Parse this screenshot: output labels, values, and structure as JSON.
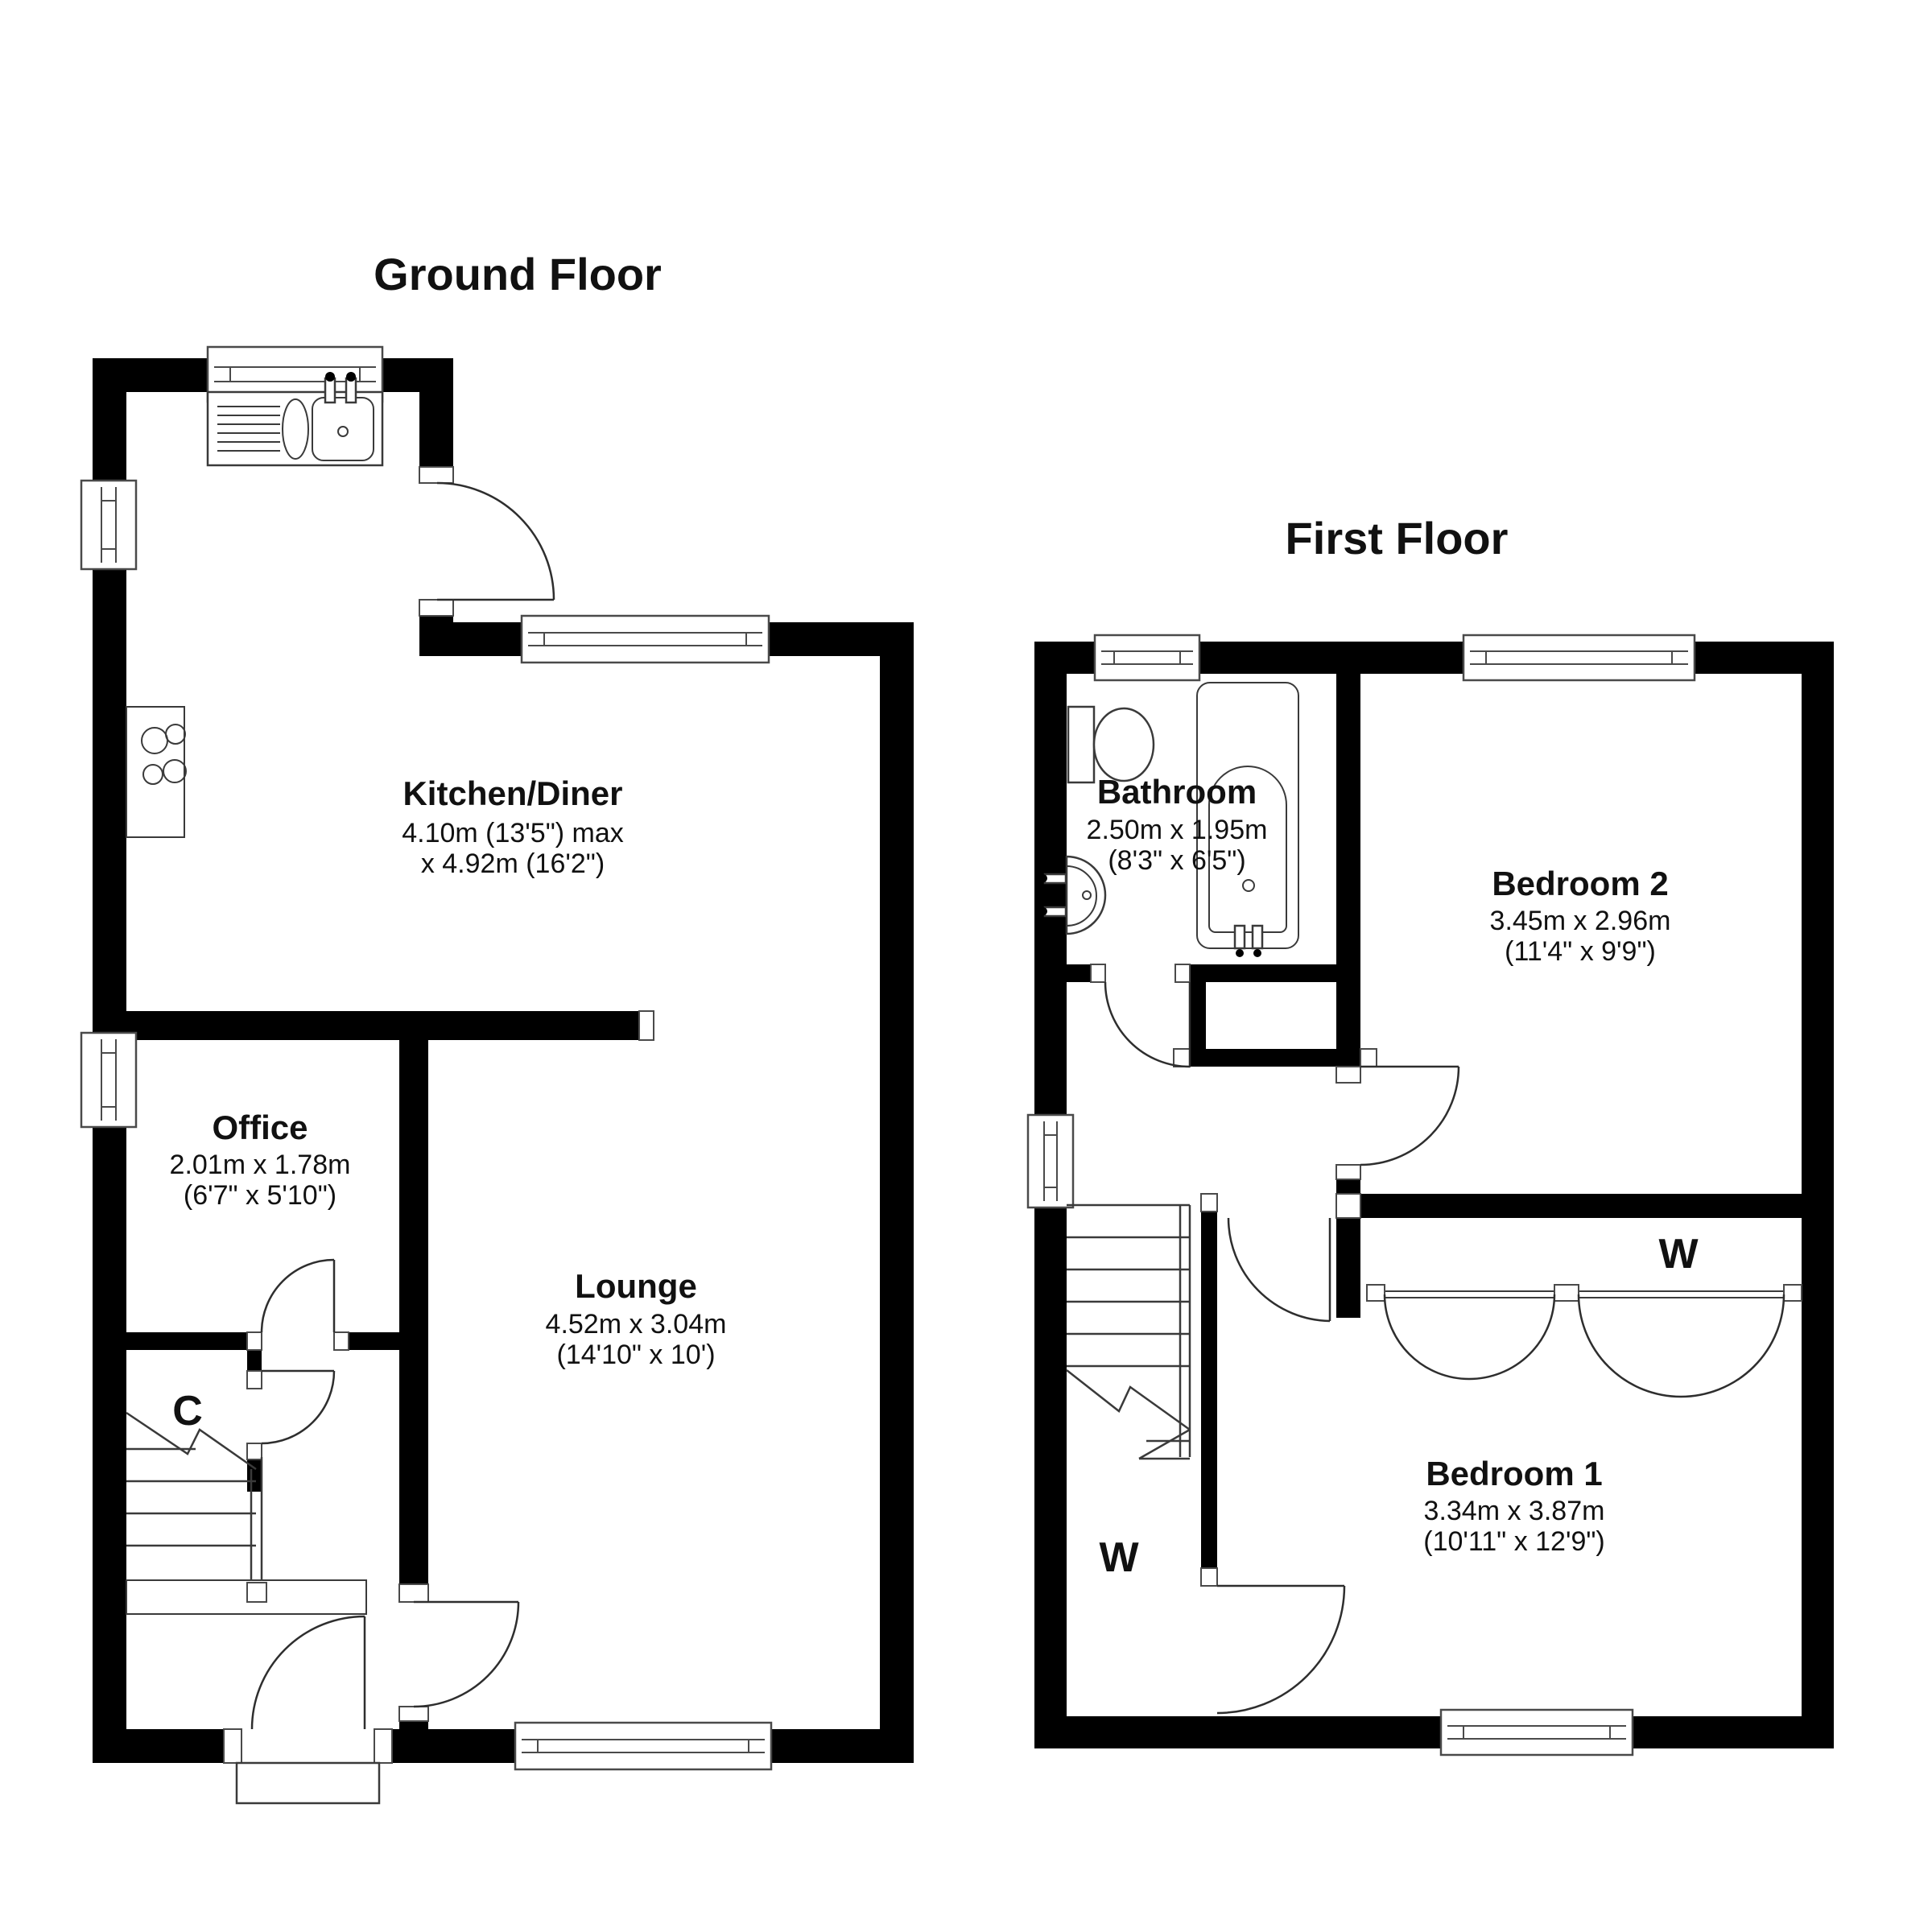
{
  "page": {
    "background": "#ffffff",
    "wall_color": "#000000",
    "line_color": "#3a3a3a"
  },
  "ground_floor": {
    "title": "Ground Floor",
    "rooms": {
      "kitchen": {
        "name": "Kitchen/Diner",
        "dim1": "4.10m (13'5\") max",
        "dim2": "x 4.92m (16'2\")"
      },
      "office": {
        "name": "Office",
        "dim1": "2.01m x 1.78m",
        "dim2": "(6'7\" x 5'10\")"
      },
      "lounge": {
        "name": "Lounge",
        "dim1": "4.52m x 3.04m",
        "dim2": "(14'10\" x 10')"
      },
      "cupboard": {
        "label": "C"
      }
    }
  },
  "first_floor": {
    "title": "First Floor",
    "rooms": {
      "bathroom": {
        "name": "Bathroom",
        "dim1": "2.50m x 1.95m",
        "dim2": "(8'3\" x 6'5\")"
      },
      "bedroom2": {
        "name": "Bedroom 2",
        "dim1": "3.45m x 2.96m",
        "dim2": "(11'4\" x 9'9\")"
      },
      "bedroom1": {
        "name": "Bedroom 1",
        "dim1": "3.34m x 3.87m",
        "dim2": "(10'11\" x 12'9\")"
      },
      "wardrobe_bedroom1": {
        "label": "W"
      },
      "wardrobe_landing": {
        "label": "W"
      }
    }
  }
}
